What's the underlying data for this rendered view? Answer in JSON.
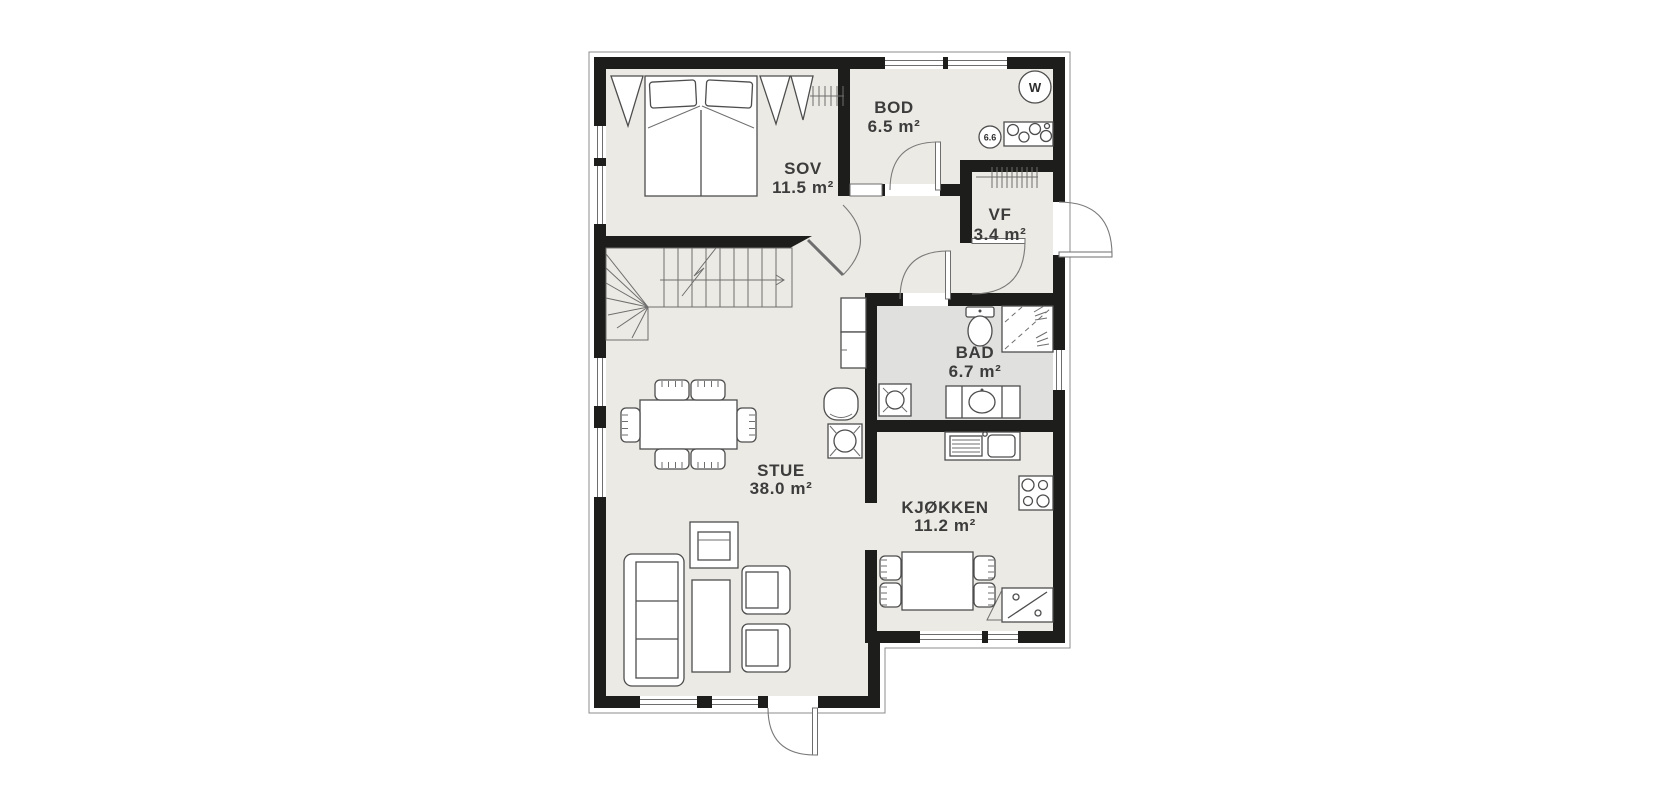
{
  "rooms": [
    {
      "name": "SOV",
      "area": "11.5 m²"
    },
    {
      "name": "BOD",
      "area": "6.5 m²"
    },
    {
      "name": "VF",
      "area": "3.4 m²"
    },
    {
      "name": "BAD",
      "area": "6.7 m²"
    },
    {
      "name": "STUE",
      "area": "38.0 m²"
    },
    {
      "name": "KJØKKEN",
      "area": "11.2 m²"
    }
  ],
  "symbols": {
    "water_heater": "W",
    "smoke_detector": "6.6"
  },
  "icons": [
    "double-bed",
    "wardrobe",
    "coat-rail",
    "staircase",
    "stairs-direction-arrow",
    "dining-table",
    "dining-chair",
    "sofa",
    "coffee-table",
    "tv-bench",
    "armchair",
    "round-chair",
    "fireplace",
    "hall-cabinet",
    "kitchen-sink",
    "cooktop",
    "corner-cabinet",
    "kitchen-table",
    "kitchen-chair",
    "toilet",
    "shower",
    "vanity-sink",
    "floor-drain",
    "water-heater",
    "smoke-detector",
    "laundry-counter",
    "wardrobe-rail",
    "entrance-door",
    "terrace-door",
    "interior-door"
  ],
  "colors": {
    "wall": "#1D1D1B",
    "floor": "#ECEAE4",
    "bathroom_floor": "#E0E0DE",
    "furniture_line": "#4D4D4D",
    "thin_line": "#8C8C8C",
    "label": "#3C3C3C",
    "background": "#FFFFFF"
  }
}
